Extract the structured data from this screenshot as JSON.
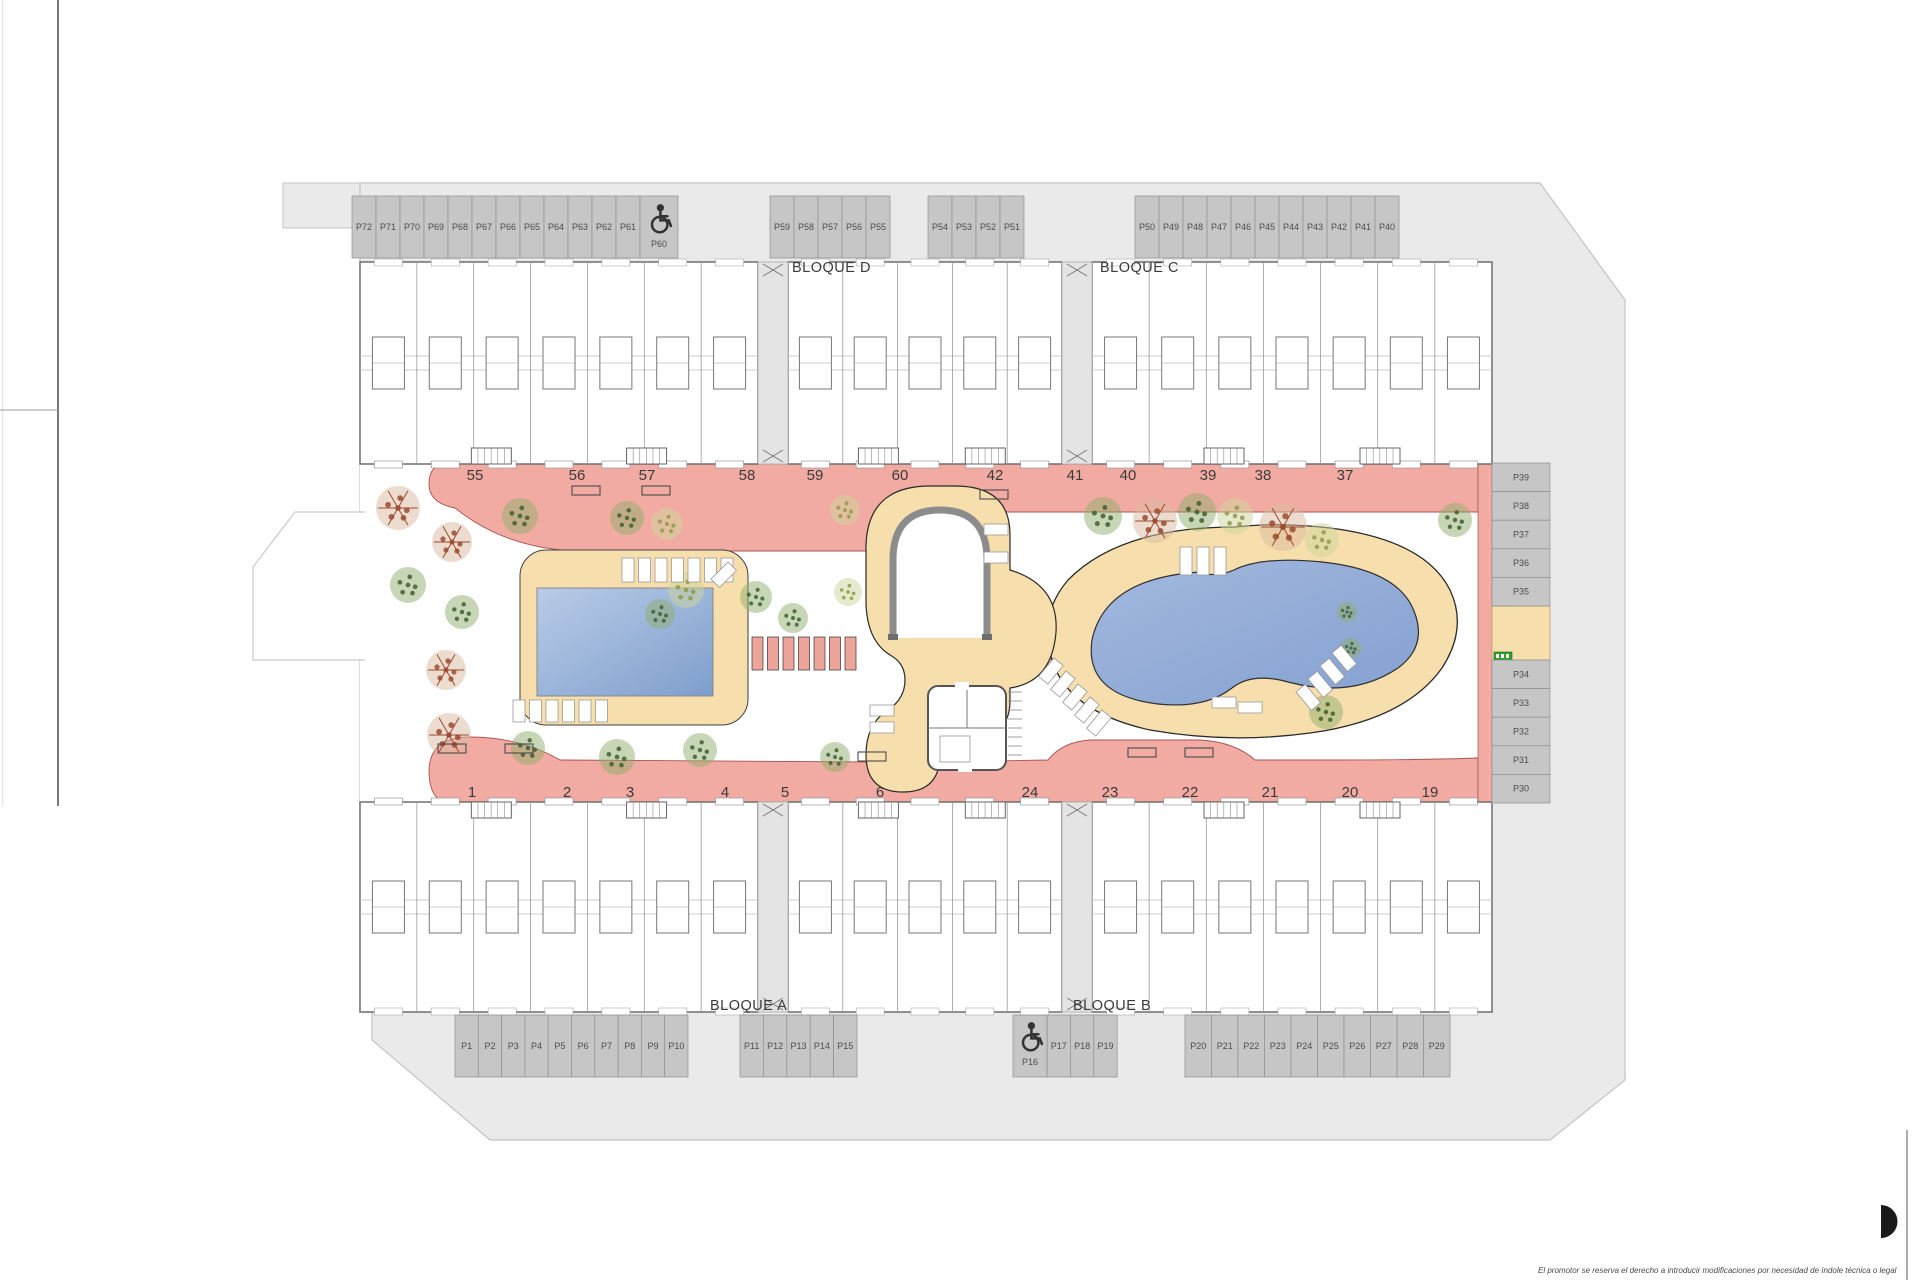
{
  "plan_title": "Residential site plan",
  "blocks": {
    "a": "BLOQUE A",
    "b": "BLOQUE B",
    "c": "BLOQUE C",
    "d": "BLOQUE D"
  },
  "parking": {
    "top_left": [
      "P72",
      "P71",
      "P70",
      "P69",
      "P68",
      "P67",
      "P66",
      "P65",
      "P64",
      "P63",
      "P62",
      "P61"
    ],
    "top_accessible": "P60",
    "top_center": [
      "P59",
      "P58",
      "P57",
      "P56",
      "P55"
    ],
    "top_center2": [
      "P54",
      "P53",
      "P52",
      "P51"
    ],
    "top_right": [
      "P50",
      "P49",
      "P48",
      "P47",
      "P46",
      "P45",
      "P44",
      "P43",
      "P42",
      "P41",
      "P40"
    ],
    "right_upper": [
      "P39",
      "P38",
      "P37",
      "P36",
      "P35"
    ],
    "right_lower": [
      "P34",
      "P33",
      "P32",
      "P31",
      "P30"
    ],
    "bottom_left": [
      "P1",
      "P2",
      "P3",
      "P4",
      "P5",
      "P6",
      "P7",
      "P8",
      "P9",
      "P10"
    ],
    "bottom_center": [
      "P11",
      "P12",
      "P13",
      "P14",
      "P15"
    ],
    "bottom_accessible": "P16",
    "bottom_center2": [
      "P17",
      "P18",
      "P19"
    ],
    "bottom_right": [
      "P20",
      "P21",
      "P22",
      "P23",
      "P24",
      "P25",
      "P26",
      "P27",
      "P28",
      "P29"
    ]
  },
  "units": {
    "top": [
      "55",
      "56",
      "57",
      "58",
      "59",
      "60",
      "42",
      "41",
      "40",
      "39",
      "38",
      "37"
    ],
    "bottom": [
      "1",
      "2",
      "3",
      "4",
      "5",
      "6",
      "24",
      "23",
      "22",
      "21",
      "20",
      "19"
    ]
  },
  "disclaimer": "El promotor se reserva el derecho a introducir modificaciones por necesidad de índole técnica o legal",
  "icons": {
    "accessible": "wheelchair-icon",
    "exit": "emergency-exit-sign",
    "gate": "gate-cross-icon"
  },
  "colors": {
    "walkway": "#f2aba3",
    "walkway_edge": "#a85550",
    "deck": "#f7dfad",
    "pool_light": "#b7c9e6",
    "pool_dark": "#7e9fcc",
    "road": "#eaeaea",
    "stall": "#c6c6c6",
    "exit_green": "#2f9e2f",
    "tree_green": "#4a6b35",
    "tree_red": "#9c4a2f",
    "tree_olive": "#8f9a4a"
  }
}
